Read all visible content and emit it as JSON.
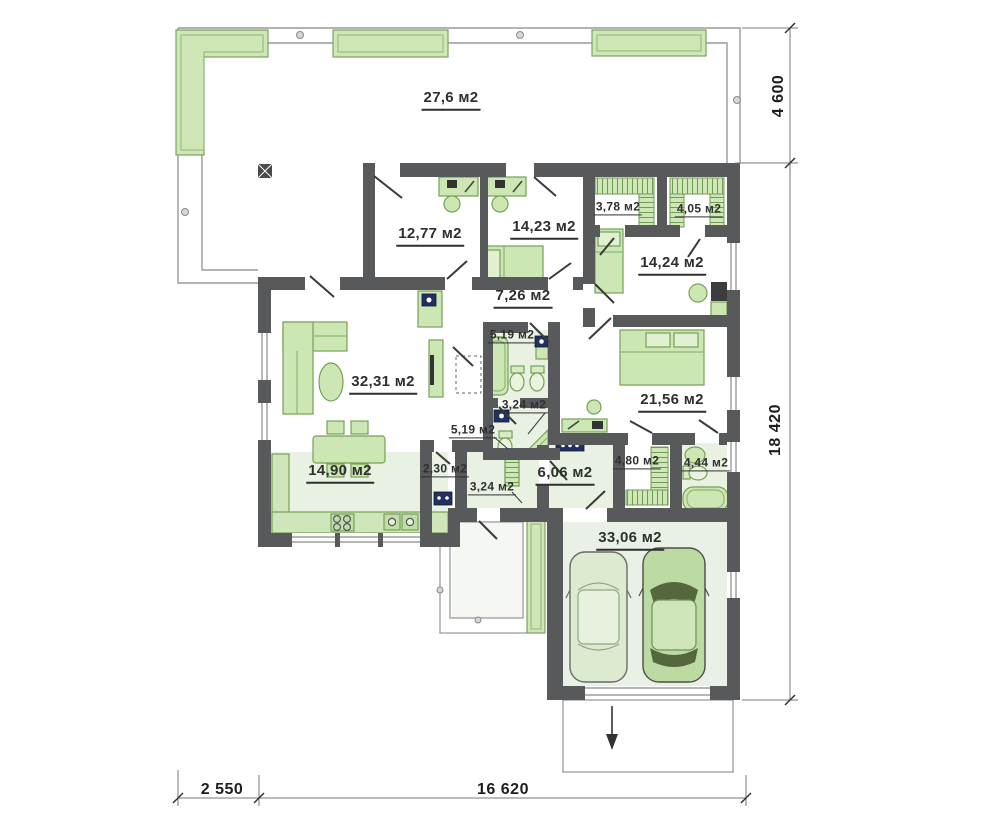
{
  "plan": {
    "type": "floor-plan",
    "unit_suffix": "м2",
    "colors": {
      "wall": "#58595b",
      "furniture_fill": "#cde7b4",
      "furniture_stroke": "#76a058",
      "floor_tint": "#e9f1e3",
      "planter_fill": "#cfe7b6",
      "accent_navy": "#22305e",
      "outline_gray": "#9a9a9a"
    }
  },
  "rooms": {
    "terrace": {
      "area": "27,6 м2"
    },
    "bedroom_left": {
      "area": "12,77 м2"
    },
    "bedroom_mid": {
      "area": "14,23 м2"
    },
    "wardrobe_a": {
      "area": "3,78 м2"
    },
    "wardrobe_b": {
      "area": "4,05 м2"
    },
    "bedroom_right": {
      "area": "14,24 м2"
    },
    "hallway": {
      "area": "7,26 м2"
    },
    "bathroom_top": {
      "area": "5,19 м2"
    },
    "living_room": {
      "area": "32,31 м2"
    },
    "shower_room": {
      "area": "3,24 м2"
    },
    "wc": {
      "area": "5,19 м2"
    },
    "bedroom_master": {
      "area": "21,56 м2"
    },
    "kitchen": {
      "area": "14,90 м2"
    },
    "pantry": {
      "area": "2,30 м2"
    },
    "vestibule": {
      "area": "3,24 м2"
    },
    "entry_hall": {
      "area": "6,06 м2"
    },
    "walkin_closet": {
      "area": "4,80 м2"
    },
    "bathroom_bottom": {
      "area": "4,44 м2"
    },
    "garage": {
      "area": "33,06 м2"
    }
  },
  "dimensions": {
    "terrace_depth": "4 600",
    "house_depth": "18 420",
    "offset_left": "2 550",
    "house_width": "16 620"
  }
}
